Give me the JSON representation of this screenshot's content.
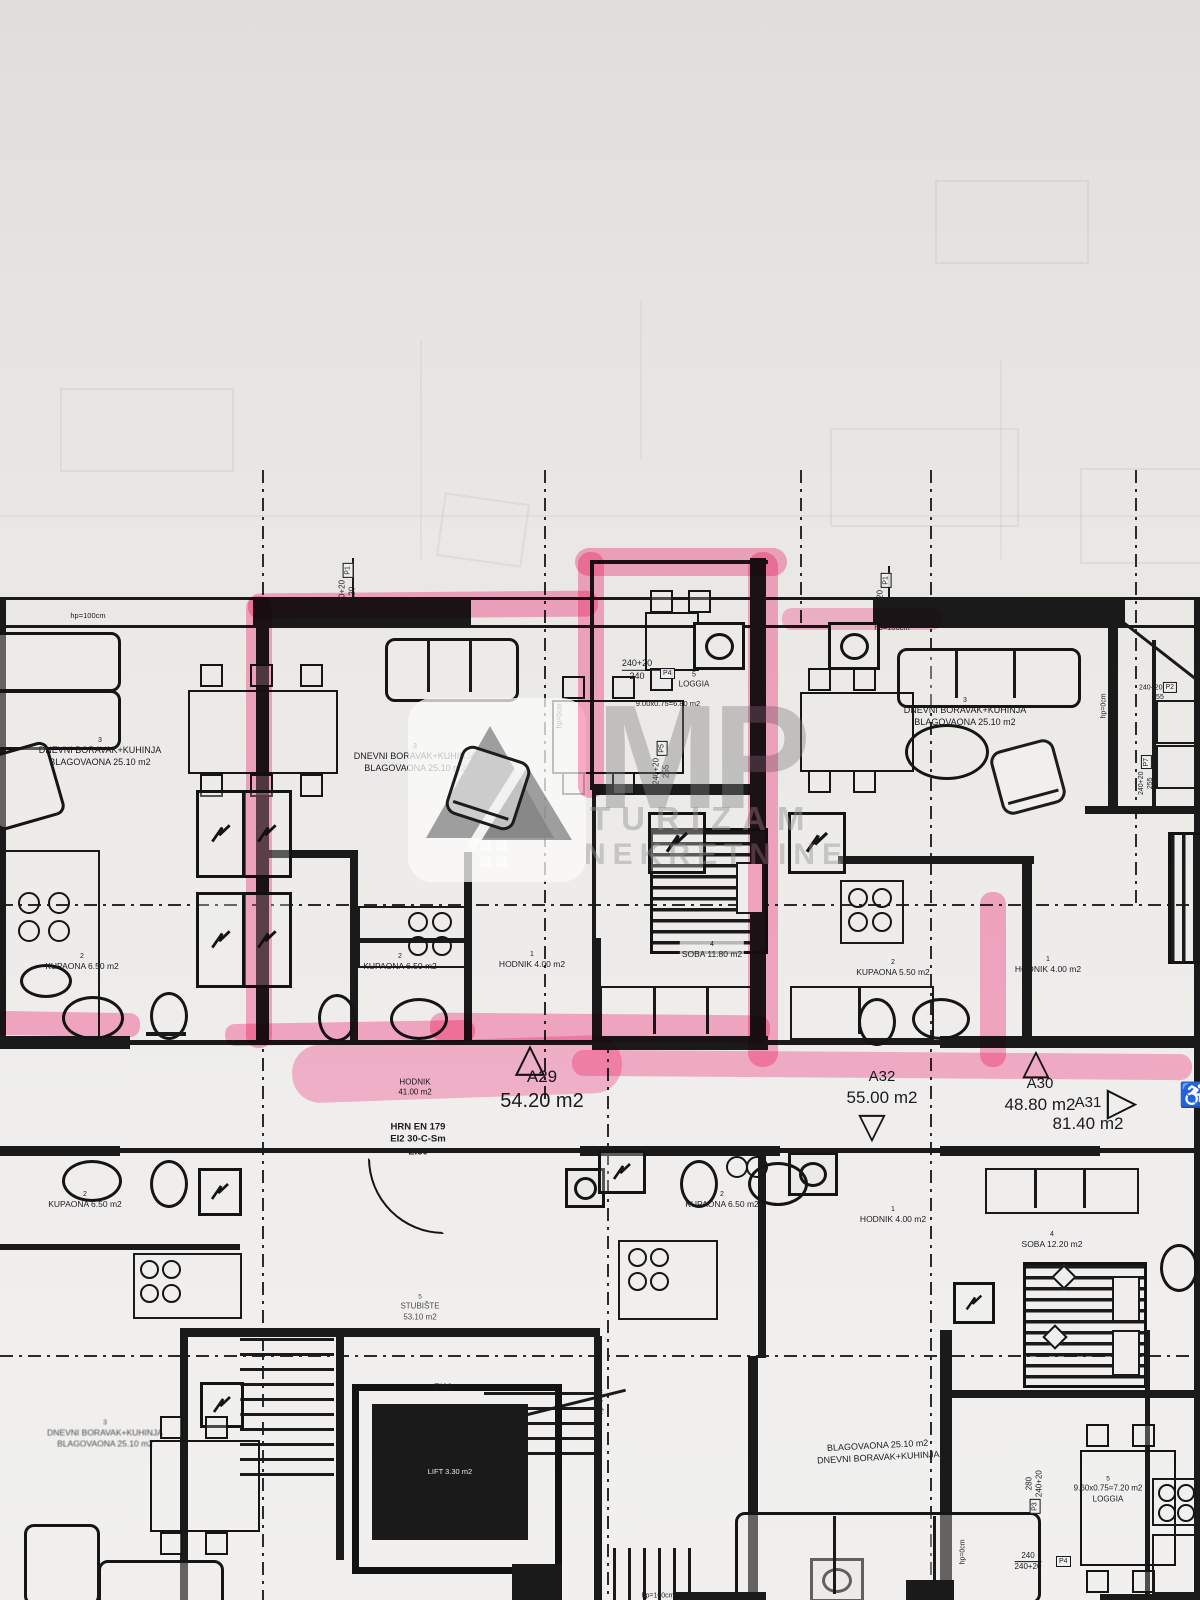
{
  "watermark": {
    "initials": "MP",
    "line1": "TURIZAM",
    "line2": "NEKRETNINE",
    "logo": "house-roof-logo"
  },
  "units": {
    "a29": {
      "id": "A29",
      "area": "54.20 m2"
    },
    "a32": {
      "id": "A32",
      "area": "55.00 m2"
    },
    "a30": {
      "id": "A30",
      "area": "48.80 m2"
    },
    "a31": {
      "id": "A31",
      "area": "81.40 m2"
    }
  },
  "rooms": {
    "living": {
      "num": "3",
      "line1": "DNEVNI BORAVAK+KUHINJA",
      "line2": "BLAGOVAONA 25.10 m2"
    },
    "living_swapped": {
      "line1": "BLAGOVAONA 25.10 m2",
      "line2": "DNEVNI BORAVAK+KUHINJA"
    },
    "loggia_a29": {
      "num": "5",
      "name": "LOGGIA",
      "calc": "9.00x0.75=6.80 m2"
    },
    "loggia_se": {
      "num": "5",
      "calc": "9.60x0.75=7.20 m2",
      "name": "LOGGIA"
    },
    "kupaona_650": {
      "num": "2",
      "text": "KUPAONA 6.50 m2"
    },
    "kupaona_550": {
      "num": "2",
      "text": "KUPAONA 5.50 m2"
    },
    "hodnik_4": {
      "num": "1",
      "text": "HODNIK 4.00 m2"
    },
    "soba_1180": {
      "num": "4",
      "text": "SOBA 11.80 m2"
    },
    "soba_1220": {
      "num": "4",
      "text": "SOBA 12.20 m2"
    },
    "hodnik_main": {
      "line1": "HODNIK",
      "line2": "41.00 m2"
    },
    "stubiste": {
      "num": "5",
      "line1": "STUBIŠTE",
      "line2": "53.10 m2"
    },
    "lift": {
      "text": "LIFT 3.30 m2"
    },
    "soba_cut": {
      "text": "SOBA 1"
    },
    "kupaona_cut": {
      "text": "KUPAON"
    }
  },
  "fire": {
    "line1": "HRN EN 179",
    "line2": "EI2 30-C-Sm",
    "line3": "EI30",
    "door": "EI60"
  },
  "dims": {
    "p1": {
      "tag": "P1",
      "a": "140+20",
      "b": "120"
    },
    "p2": {
      "tag": "P2",
      "a": "240+20",
      "b": "255"
    },
    "p3": {
      "tag": "P3",
      "a": "280",
      "b": "240+20"
    },
    "p4_top": {
      "tag": "P4",
      "a": "240+20",
      "b": "240"
    },
    "p4_bottom": {
      "tag": "P4",
      "a": "240",
      "b": "240+20"
    },
    "p5": {
      "tag": "P5",
      "a": "240+20",
      "b": "255"
    },
    "p7": {
      "tag": "P7",
      "a": "240+20",
      "b": "255"
    },
    "hp0": "hp=0cm",
    "hp100": "hp=100cm"
  },
  "icons": {
    "tri_up": "△",
    "tri_down": "▽",
    "tri_right": "▷",
    "wheelchair": "♿"
  },
  "colors": {
    "highlight_pink": "#ff5f9e",
    "ink": "#1a1a1a",
    "paper": "#ebe9e6",
    "watermark_gray": "#949496"
  }
}
